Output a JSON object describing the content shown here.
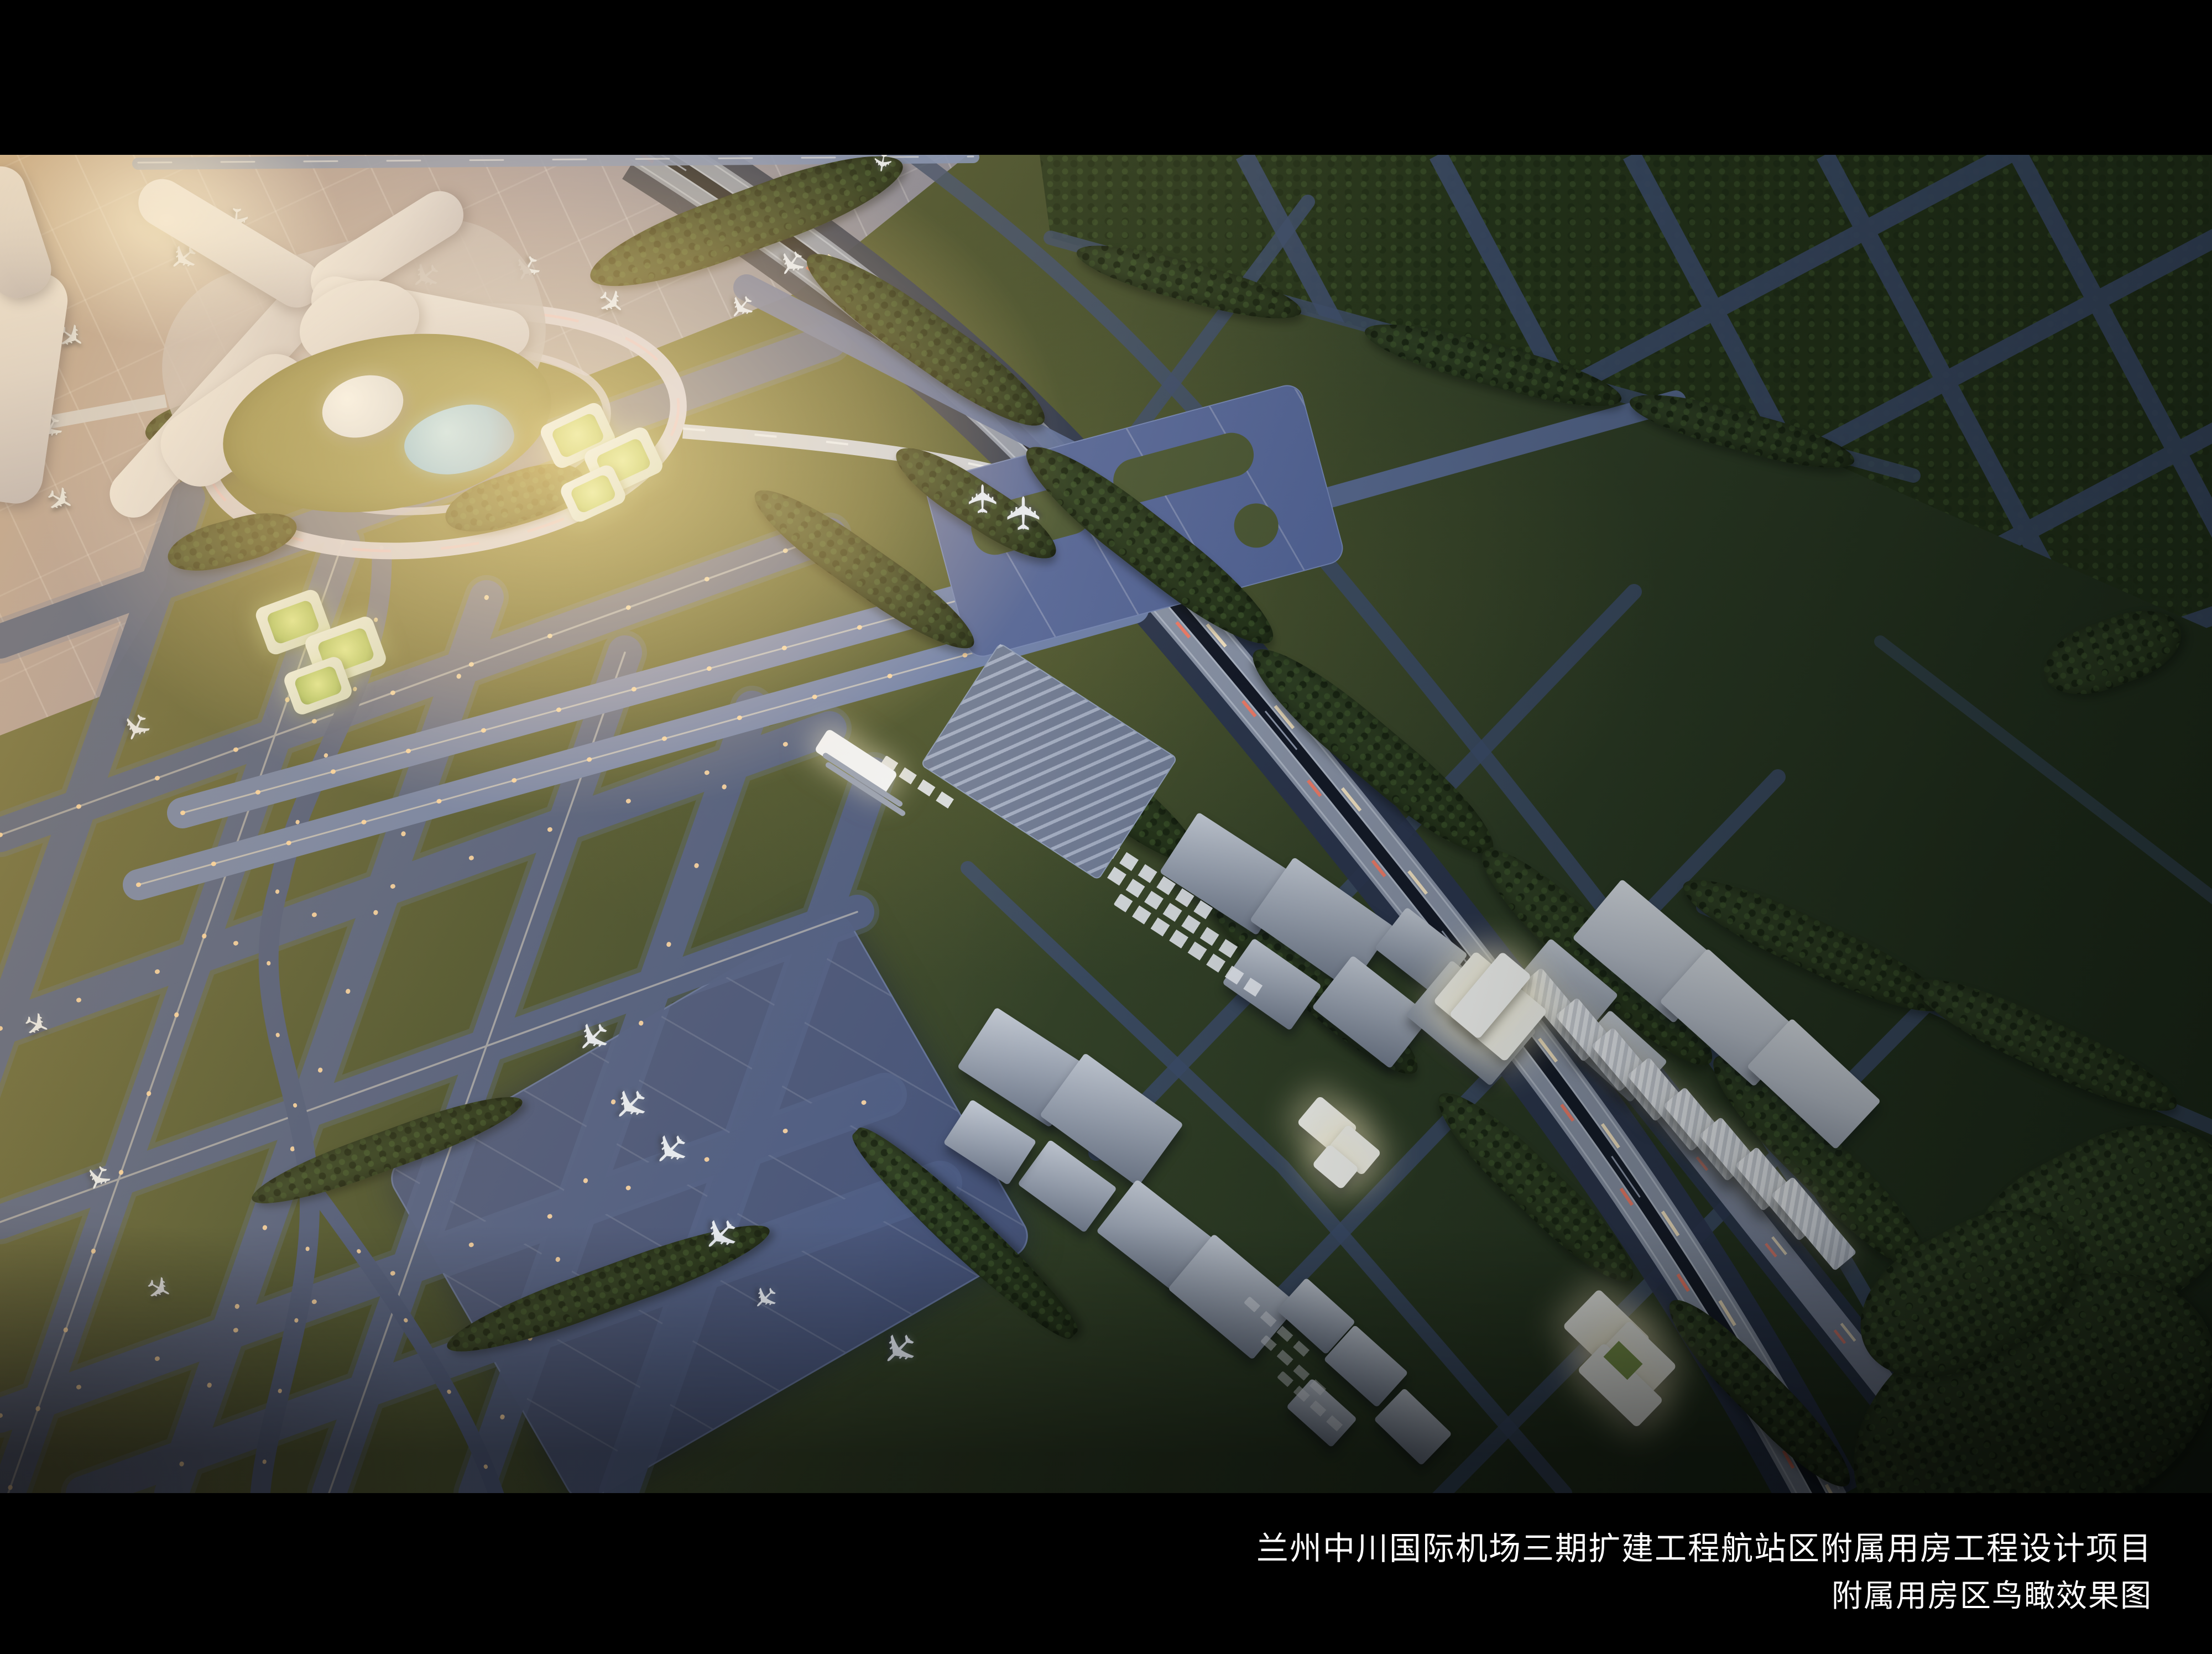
{
  "caption": {
    "line1": "兰州中川国际机场三期扩建工程航站区附属用房工程设计项目",
    "line2": "附属用房区鸟瞰效果图"
  },
  "icons": {
    "airplane": "✈"
  },
  "palette": {
    "letterbox": "#000000",
    "caption_text": "#ffffff",
    "sun_glow": "#f0c87a",
    "grass_sunlit": "#6a7040",
    "grass_dark": "#2c3a22",
    "taxiway_blue": "#4c5c84",
    "runway_band": "#6d80ab",
    "apron_gray": "#98909f",
    "remote_apron": "#47557b",
    "expressway_deck": "#8d97ab",
    "minor_road": "#3d4e6c",
    "forest_green": "#26331d",
    "terminal_white": "#efedef",
    "building_gray": "#9aa3b2",
    "building_lit": "#f7f8f4",
    "pond_cyan": "#6ec6e8",
    "taxi_light_amber": "#ffd9a6",
    "trail_white": "#ffedc9",
    "trail_red": "#ff7a62"
  }
}
